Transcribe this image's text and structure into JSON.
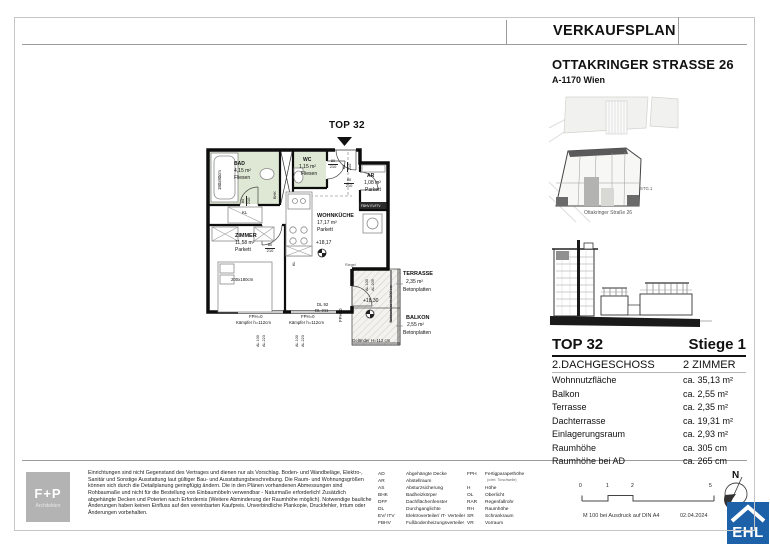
{
  "sheet": {
    "title": "VERKAUFSPLAN",
    "address_line1": "OTTAKRINGER STRASSE 26",
    "address_line2": "A-1170 Wien"
  },
  "site_plan": {
    "stg_label": "STG.1",
    "caption": "Ottakringer Straße 26"
  },
  "unit_info": {
    "top": "TOP 32",
    "stiege": "Stiege 1",
    "floor": "2.DACHGESCHOSS",
    "rooms": "2 ZIMMER",
    "rows": [
      {
        "label": "Wohnnutzfläche",
        "value": "ca. 35,13 m²"
      },
      {
        "label": "Balkon",
        "value": "ca. 2,55 m²"
      },
      {
        "label": "Terrasse",
        "value": "ca. 2,35 m²"
      },
      {
        "label": "Dachterrasse",
        "value": "ca. 19,31 m²"
      },
      {
        "label": "Einlagerungsraum",
        "value": "ca. 2,93 m²"
      },
      {
        "label": "Raumhöhe",
        "value": "ca. 305 cm"
      },
      {
        "label": "Raumhöhe bei AD",
        "value": "ca. 265 cm"
      }
    ]
  },
  "floor_plan": {
    "unit_label": "TOP 32",
    "rooms": {
      "bad": {
        "name": "BAD",
        "area": "4,15 m²",
        "floor": "Fliesen"
      },
      "wc": {
        "name": "WC",
        "area": "1,15 m²",
        "floor": "Fliesen"
      },
      "ar": {
        "name": "AR",
        "area": "1,08 m²",
        "floor": "Parkett"
      },
      "wohnkueche": {
        "name": "WOHNKÜCHE",
        "area": "17,17 m²",
        "floor": "Parkett"
      },
      "zimmer": {
        "name": "ZIMMER",
        "area": "11,58 m²",
        "floor": "Parkett"
      },
      "terrasse": {
        "name": "TERRASSE",
        "area": "2,35 m²",
        "floor": "Betonplatten"
      },
      "balkon": {
        "name": "BALKON",
        "area": "2,55 m²",
        "floor": "Betonplatten"
      }
    },
    "annotations": {
      "bathtub": "180x80cm",
      "bed": "200x180cm",
      "bhk": "BHK",
      "kl": "KL",
      "door_w": "80",
      "door_h": "210",
      "level_inside": "+18,17",
      "level_terrace": "+18,30",
      "fph0": "FPH=0",
      "kaempfer": "Kämpfer h=112cm",
      "dl_92": "DL 92",
      "dl_211": "DL 211",
      "al_100": "AL 100",
      "al_223": "AL 223",
      "al_209": "AL 209",
      "fbhv": "FBHV EV/ITV",
      "riegel": "Riegel",
      "sichtschutz": "Sichtschutz H=200 cm",
      "gelaender": "Geländer H=112 cm"
    }
  },
  "footer": {
    "disclaimer": "Einrichtungen sind nicht Gegenstand des Vertrages und dienen nur als Vorschlag. Boden- und Wandbeläge, Elektro-, Sanitär und Sonstige Ausstattung laut gültiger Bau- und Ausstattungsbeschreibung. Die Raum- und Wohnungsgrößen können sich durch die Detailplanung geringfügig ändern. Die in den Plänen vorhandenen Abmessungen sind Rohbaumaße und nicht für die Bestellung von Einbaumöbeln verwendbar - Naturmaße erforderlich! Zusätzlich abgehängte Decken und Poterien nach Erfordernis (Weitere Abminderung der Raumhöhe möglich). Notwendige bauliche Änderungen haben keinen Einfluss auf den vereinbarten Kaufpreis. Unverbindliche Plankopie, Druckfehler, Irrtum oder Änderungen vorbehalten.",
    "abbreviations_col1": [
      {
        "abbr": "AD",
        "meaning": "Abgehängte Decke"
      },
      {
        "abbr": "AR",
        "meaning": "Abstellraum"
      },
      {
        "abbr": "AS",
        "meaning": "Absturzsicherung"
      },
      {
        "abbr": "BHK",
        "meaning": "Badheizkörper"
      },
      {
        "abbr": "DFF",
        "meaning": "Dachflächenfenster"
      },
      {
        "abbr": "DL",
        "meaning": "Durchganglichte"
      },
      {
        "abbr": "EV/ ITV",
        "meaning": "Elektroverteiler/ IT- Verteiler"
      },
      {
        "abbr": "FBHV",
        "meaning": "Fußbodenheizungsverteiler"
      }
    ],
    "abbreviations_col2": [
      {
        "abbr": "FPH",
        "meaning": "Fertigparapethöhe",
        "note": "(v.fert. Türschwelle)"
      },
      {
        "abbr": "H",
        "meaning": "Höhe"
      },
      {
        "abbr": "OL",
        "meaning": "Oberlicht"
      },
      {
        "abbr": "RAR",
        "meaning": "Regenfallrohr"
      },
      {
        "abbr": "RH",
        "meaning": "Raumhöhe"
      },
      {
        "abbr": "SR",
        "meaning": "Schrankraum"
      },
      {
        "abbr": "VR",
        "meaning": "Vorraum"
      }
    ],
    "scale_ticks": [
      "0",
      "1",
      "2",
      "5"
    ],
    "print_note": "M 100 bei Ausdruck auf DIN A4",
    "date": "02.04.2024",
    "north_label": "N"
  },
  "logos": {
    "architect_line1": "F+P",
    "architect_line2": "Architekten",
    "broker": "EHL"
  },
  "colors": {
    "wet_room_green": "#dfe8d4",
    "ehl_blue": "#1d62a8",
    "architect_gray": "#b3b3b3"
  }
}
